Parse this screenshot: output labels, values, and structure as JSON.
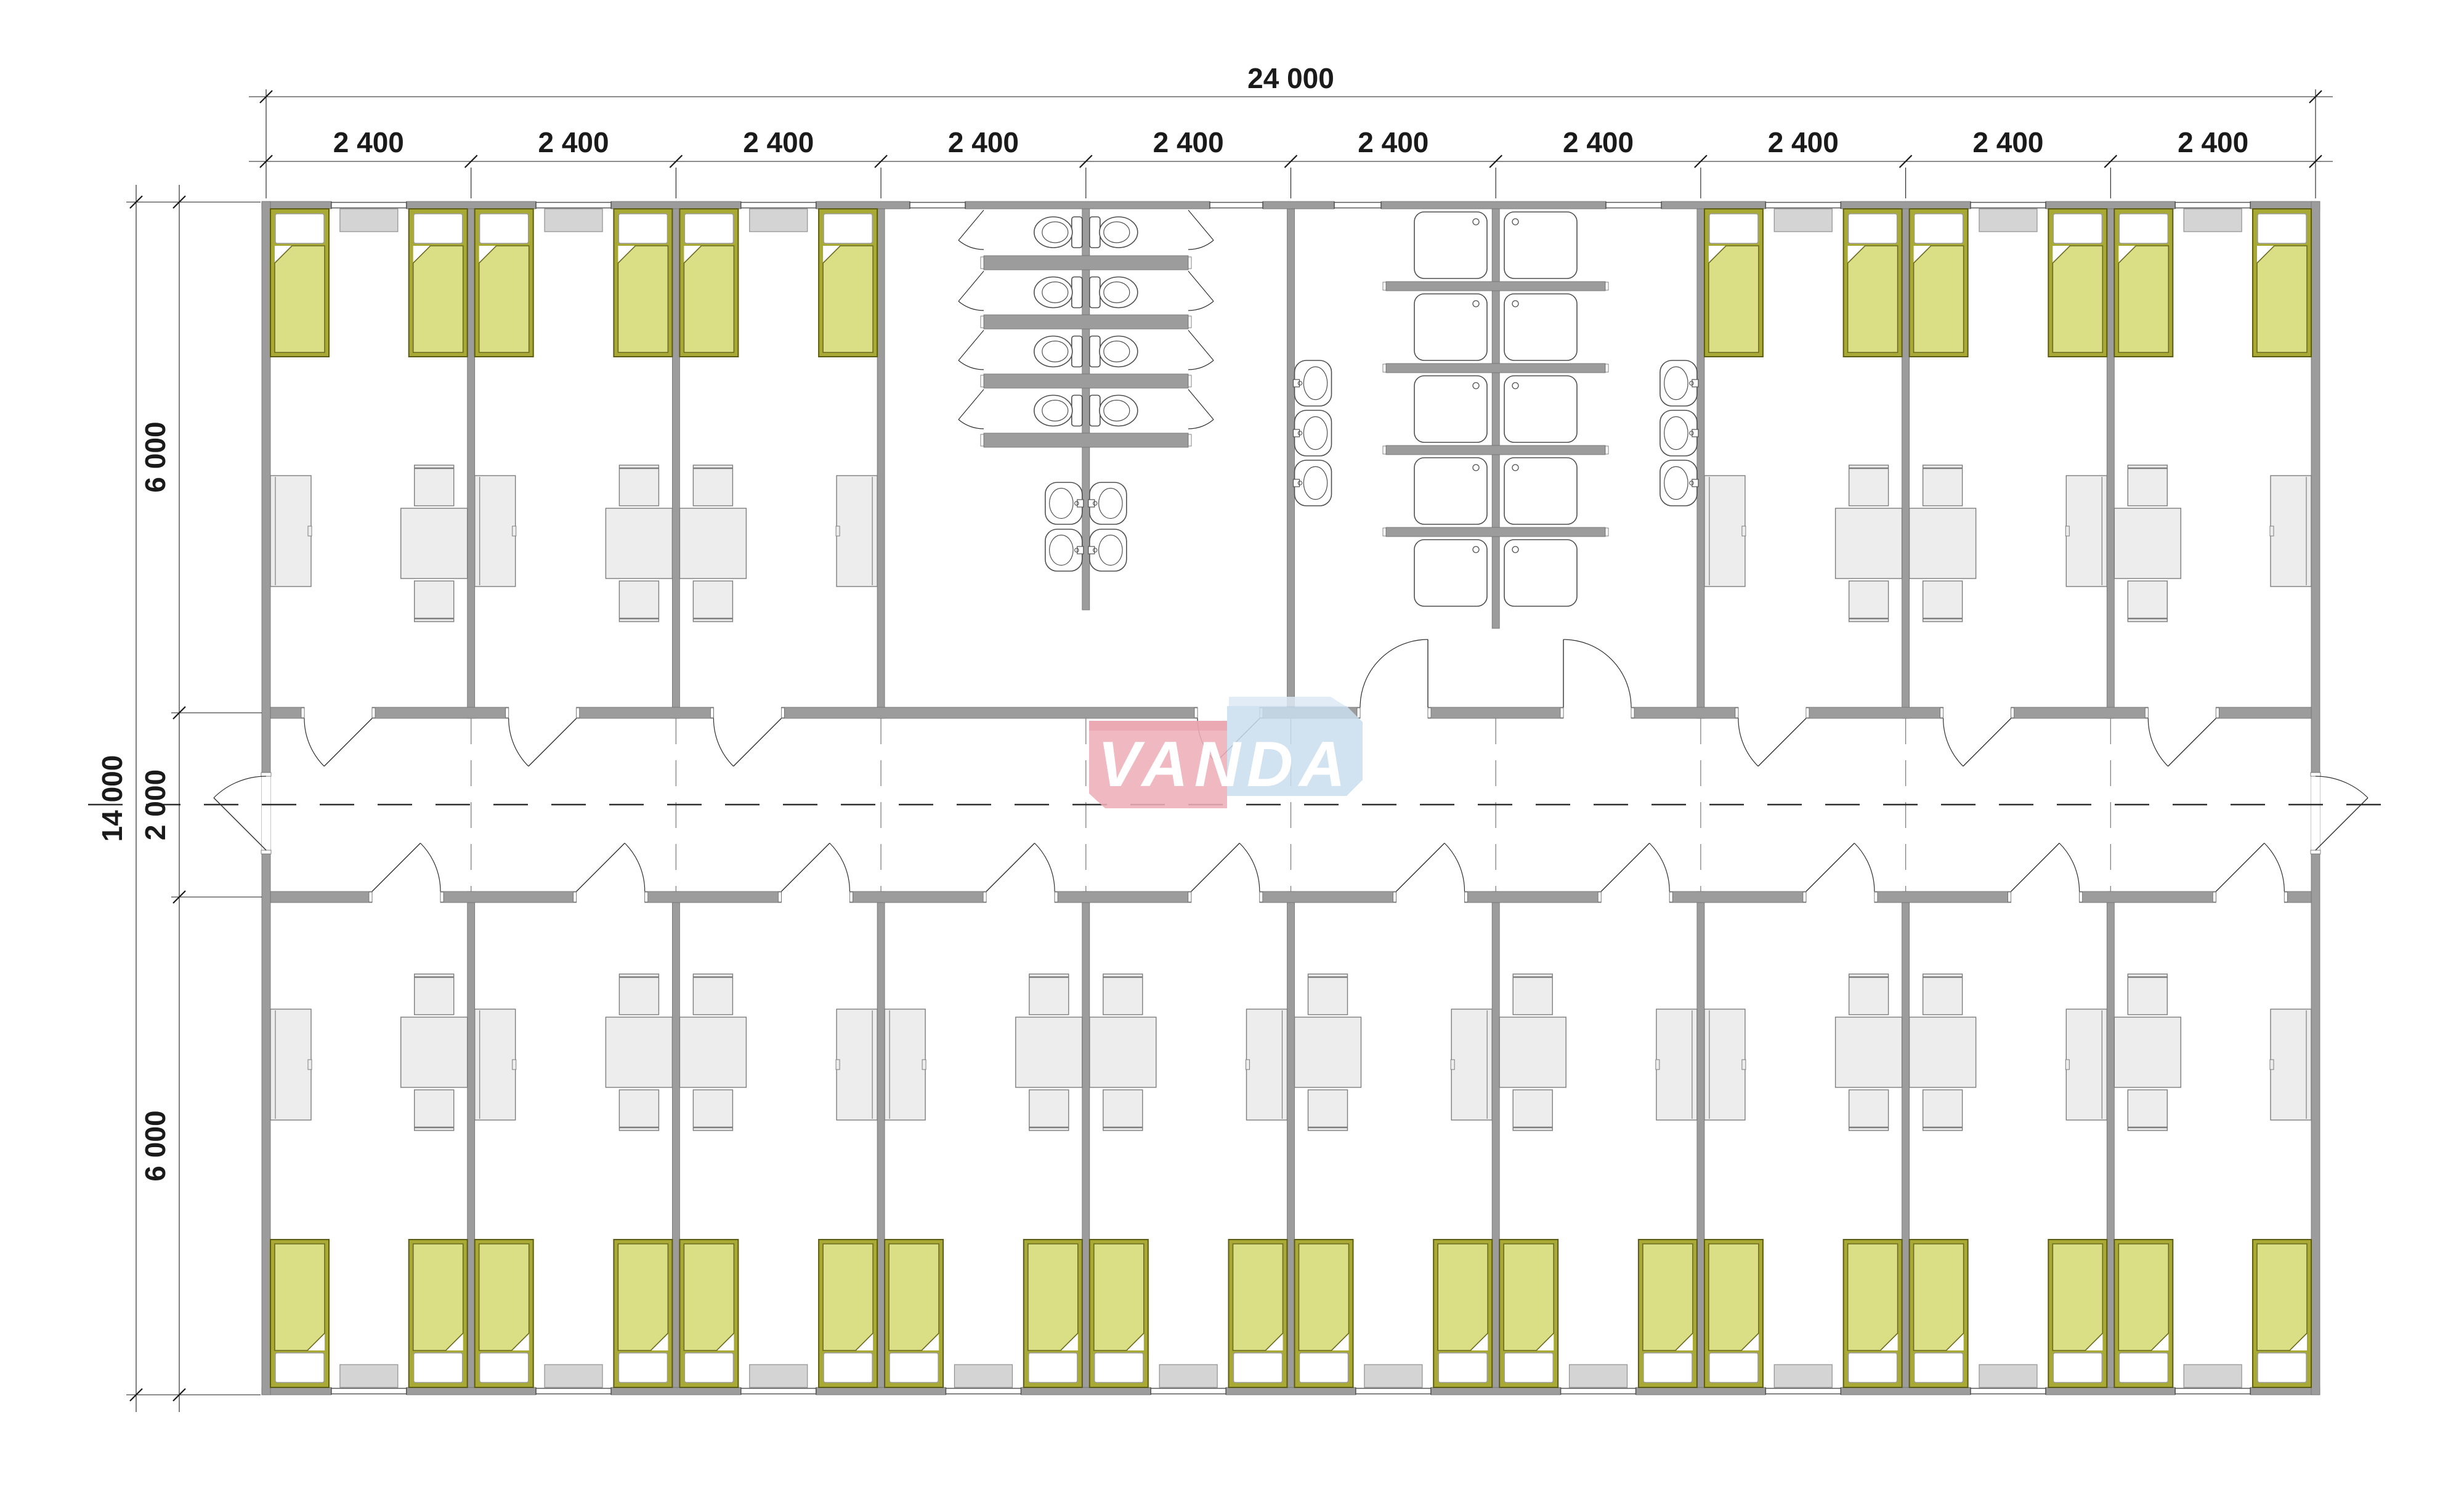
{
  "title": "Modular dormitory floor plan 24000 x 14000",
  "logo": {
    "text": "VANDA",
    "pink": "#eeafb8",
    "pink_dark": "#e59ca7",
    "blue": "#c9dded",
    "blue_flap": "#dde9f5",
    "text_color": "#ffffff"
  },
  "dimensions": {
    "top_total": "24 000",
    "top_bays": [
      "2 400",
      "2 400",
      "2 400",
      "2 400",
      "2 400",
      "2 400",
      "2 400",
      "2 400",
      "2 400",
      "2 400"
    ],
    "left_total": "14 000",
    "left_segments": [
      "6 000",
      "2 000",
      "6 000"
    ]
  },
  "colors": {
    "wall": "#9c9c9c",
    "wall_stroke": "#6f6f6f",
    "bed_frame": "#a9aa35",
    "bed_frame_stroke": "#5c5c14",
    "blanket": "#dade85",
    "blanket_stroke": "#6b6b20",
    "pillow": "#ffffff",
    "pillow_stroke": "#9a9a9a",
    "furniture": "#ededed",
    "furniture_stroke": "#7d7d7d",
    "sill": "#d4d4d4",
    "sill_stroke": "#8f8f8f",
    "fixture_stroke": "#4f4f4f",
    "dim": "#1a1a1a",
    "door": "#2f2f2f",
    "centerline": "#2e2e2e",
    "grid": "#808080"
  },
  "building": {
    "bays": 10,
    "top_rooms": [
      {
        "id": "bedroom-t1",
        "type": "bedroom",
        "bays": [
          1
        ],
        "beds": 2,
        "table_side": "right"
      },
      {
        "id": "bedroom-t2",
        "type": "bedroom",
        "bays": [
          2
        ],
        "beds": 2,
        "table_side": "right"
      },
      {
        "id": "bedroom-t3",
        "type": "bedroom",
        "bays": [
          3
        ],
        "beds": 2,
        "table_side": "left"
      },
      {
        "id": "toilet-room",
        "type": "wc",
        "bays": [
          4,
          5
        ],
        "toilets": 8,
        "washbasins": 4
      },
      {
        "id": "shower-room",
        "type": "shower",
        "bays": [
          6,
          7
        ],
        "showers": 10,
        "washbasins": 6
      },
      {
        "id": "bedroom-t8",
        "type": "bedroom",
        "bays": [
          8
        ],
        "beds": 2,
        "table_side": "right"
      },
      {
        "id": "bedroom-t9",
        "type": "bedroom",
        "bays": [
          9
        ],
        "beds": 2,
        "table_side": "left"
      },
      {
        "id": "bedroom-t10",
        "type": "bedroom",
        "bays": [
          10
        ],
        "beds": 2,
        "table_side": "left"
      }
    ],
    "bottom_rooms": [
      {
        "id": "bedroom-b1",
        "type": "bedroom",
        "bays": [
          1
        ],
        "beds": 2,
        "table_side": "right"
      },
      {
        "id": "bedroom-b2",
        "type": "bedroom",
        "bays": [
          2
        ],
        "beds": 2,
        "table_side": "right"
      },
      {
        "id": "bedroom-b3",
        "type": "bedroom",
        "bays": [
          3
        ],
        "beds": 2,
        "table_side": "left"
      },
      {
        "id": "bedroom-b4",
        "type": "bedroom",
        "bays": [
          4
        ],
        "beds": 2,
        "table_side": "right"
      },
      {
        "id": "bedroom-b5",
        "type": "bedroom",
        "bays": [
          5
        ],
        "beds": 2,
        "table_side": "left"
      },
      {
        "id": "bedroom-b6",
        "type": "bedroom",
        "bays": [
          6
        ],
        "beds": 2,
        "table_side": "left"
      },
      {
        "id": "bedroom-b7",
        "type": "bedroom",
        "bays": [
          7
        ],
        "beds": 2,
        "table_side": "left"
      },
      {
        "id": "bedroom-b8",
        "type": "bedroom",
        "bays": [
          8
        ],
        "beds": 2,
        "table_side": "right"
      },
      {
        "id": "bedroom-b9",
        "type": "bedroom",
        "bays": [
          9
        ],
        "beds": 2,
        "table_side": "left"
      },
      {
        "id": "bedroom-b10",
        "type": "bedroom",
        "bays": [
          10
        ],
        "beds": 2,
        "table_side": "left"
      }
    ]
  }
}
